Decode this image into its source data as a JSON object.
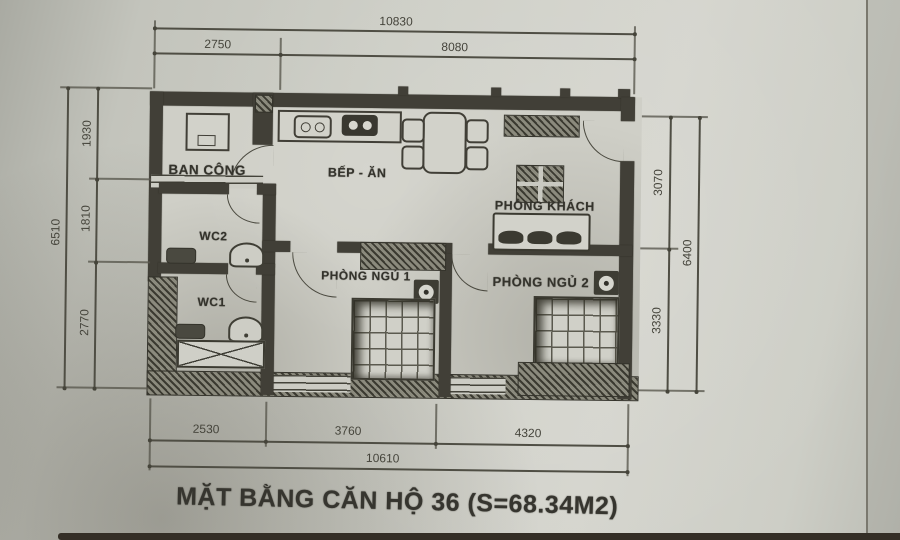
{
  "title": "MẶT BẰNG CĂN HỘ 36 (S=68.34M2)",
  "rooms": {
    "balcony": "BAN CÔNG",
    "kitchen_dining": "BẾP - ĂN",
    "living_room": "PHÒNG KHÁCH",
    "wc2": "WC2",
    "wc1": "WC1",
    "bedroom1": "PHÒNG NGỦ 1",
    "bedroom2": "PHÒNG NGỦ 2"
  },
  "dimensions": {
    "top": {
      "overall": "10830",
      "segments": [
        "2750",
        "8080"
      ]
    },
    "bottom": {
      "overall": "10610",
      "segments": [
        "2530",
        "3760",
        "4320"
      ]
    },
    "left": {
      "overall": "6510",
      "segments": [
        "1930",
        "1810",
        "2770"
      ]
    },
    "right": {
      "overall": "6400",
      "segments": [
        "3070",
        "3330"
      ]
    }
  },
  "colors": {
    "paper": "#cfcfc7",
    "ink": "#3b3a31",
    "dim_line": "#4f4e44"
  }
}
